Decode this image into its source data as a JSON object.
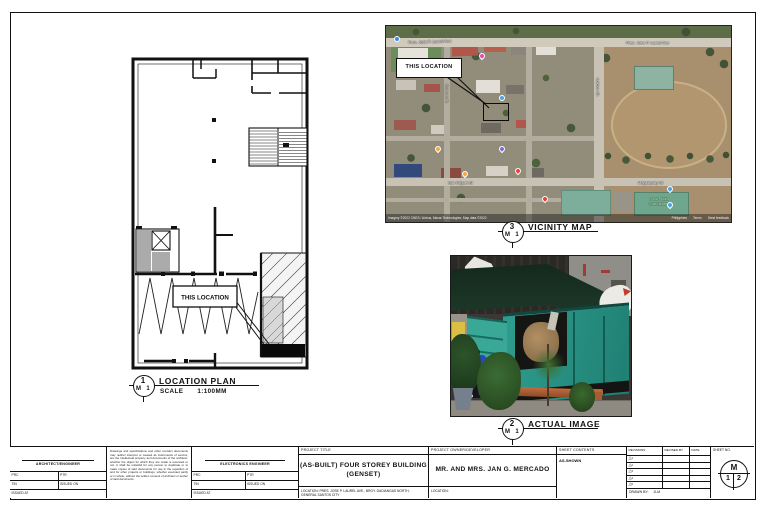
{
  "markers": {
    "location_plan": {
      "num": "1",
      "ref_left": "M",
      "ref_right": "1",
      "title": "LOCATION PLAN",
      "scale_label": "SCALE",
      "scale_value": "1:100MM"
    },
    "vicinity_map": {
      "num": "3",
      "ref_left": "M",
      "ref_right": "1",
      "title": "VICINITY MAP"
    },
    "actual_image": {
      "num": "2",
      "ref_left": "M",
      "ref_right": "1",
      "title": "ACTUAL IMAGE"
    }
  },
  "plan": {
    "callout": "THIS LOCATION"
  },
  "map": {
    "callout": "THIS LOCATION",
    "streets": {
      "laurel_left": "Pres. Jose P. Laurel Ave",
      "laurel_right": "Pres. Jose P. Laurel Ave",
      "vertical_left": "Salazar St",
      "vertical_right": "Lukban St",
      "mid": "San Miguel St",
      "bottom_right": "Magsaysay St"
    },
    "pois": {
      "oval_line1": "Oval Plaza",
      "oval_line2": "Grandstand"
    },
    "attribution": "Imagery ©2022 CNES / Airbus, Maxar Technologies, Map data ©2022",
    "attribution_links": {
      "region": "Philippines",
      "terms": "Terms",
      "feedback": "Send feedback"
    }
  },
  "titleblock": {
    "architect": {
      "title": "ARCHITECT/ENGINEER",
      "prc": "PRC",
      "ptr": "PTR",
      "tin": "TIN",
      "issued_on": "ISSUED ON",
      "issued_at": "ISSUED AT"
    },
    "engineer": {
      "title": "ELECTRONICS ENGINEER",
      "prc": "PRC",
      "ptr": "PTR",
      "tin": "TIN",
      "issued_on": "ISSUED ON",
      "issued_at": "ISSUED AT"
    },
    "disclaimer": "Drawings and specifications and other contract documents may neither interpret or caused as instruments of service, are the intellectual property and documents of the architect, whether the object for which they are made is executed or not. It shall be unlawful for any person to duplicate or to make copies of said documents for use in the repetition of and for other projects or buildings, whether executed partly or in whole, without the written consent of architect or author of said documents.",
    "project": {
      "header": "PROJECT TITLE",
      "line1": "(AS-BUILT) FOUR STOREY BUILDING",
      "line2": "(GENSET)",
      "location": "LOCATION: PRES. JOSE P. LAUREL AVE., BRGY. DADIANGAS NORTH, GENERAL SANTOS CITY"
    },
    "owner": {
      "header": "PROJECT OWNER/DEVELOPER",
      "name": "MR. AND MRS. JAN G. MERCADO",
      "location_label": "LOCATION:"
    },
    "contents": {
      "header": "SHEET CONTENTS",
      "value": "AS-SHOWN"
    },
    "revisions": {
      "header": "REVISIONS",
      "revised_by": "REVISED BY",
      "date": "DATE",
      "marks": [
        "1",
        "2",
        "3",
        "4",
        "5"
      ],
      "drawn_by_label": "DRAWN BY:",
      "drawn_by_value": "JLM"
    },
    "sheet_no": {
      "header": "SHEET NO.",
      "top": "M",
      "bottom_left": "1",
      "bottom_right": "2"
    }
  }
}
